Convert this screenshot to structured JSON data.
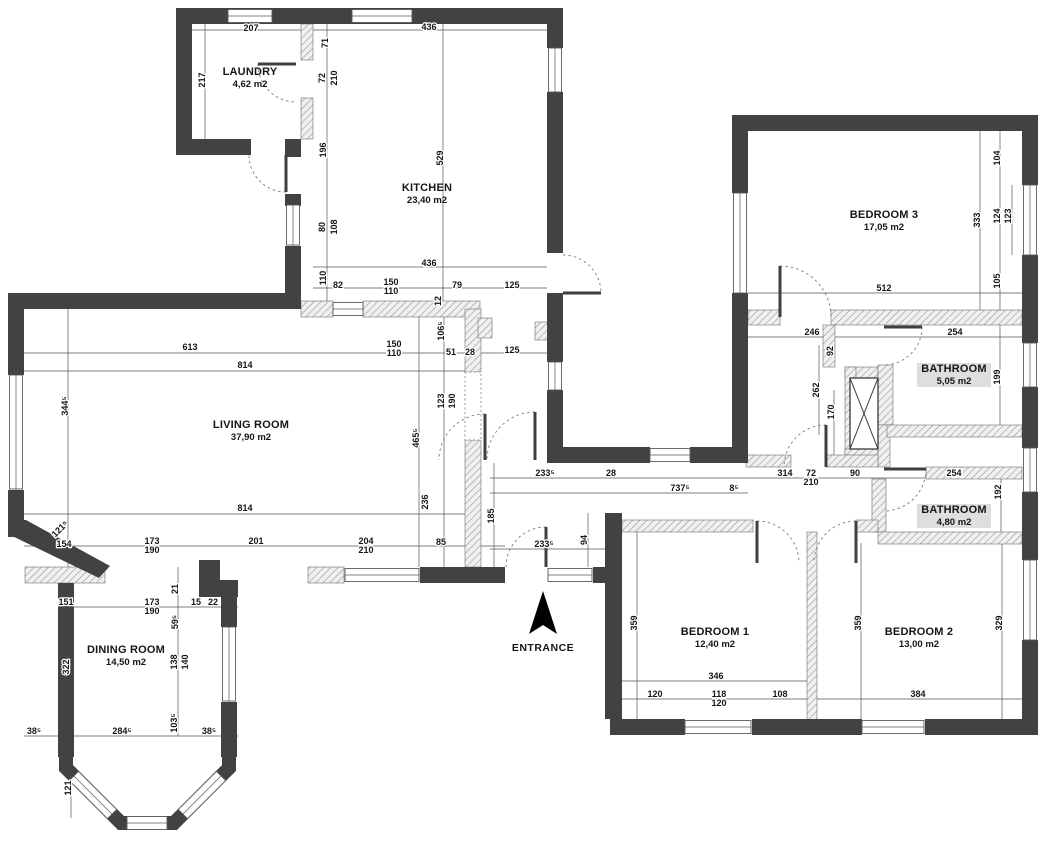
{
  "canvas": {
    "width": 1046,
    "height": 850,
    "background": "#ffffff"
  },
  "colors": {
    "wall": "#424242",
    "hatch_fill": "#f0f0f0",
    "hatch_stroke": "#8f8f8f",
    "dim_line": "#555555",
    "text": "#161616",
    "window_frame": "#5a5a5a",
    "label_highlight": "#dedede",
    "arrow": "#000000",
    "door_arc": "#7a7a7a",
    "door_leaf": "#3f3f3f"
  },
  "entrance": {
    "label": "ENTRANCE",
    "x": 543,
    "y": 651,
    "arrow_points": "543,591 557,634 543,625 529,634"
  },
  "rooms": [
    {
      "id": "laundry",
      "name": "LAUNDRY",
      "area": "4,62 m2",
      "x": 250,
      "y": 75,
      "highlight": false
    },
    {
      "id": "kitchen",
      "name": "KITCHEN",
      "area": "23,40 m2",
      "x": 427,
      "y": 191,
      "highlight": false
    },
    {
      "id": "living-room",
      "name": "LIVING ROOM",
      "area": "37,90 m2",
      "x": 251,
      "y": 428,
      "highlight": false
    },
    {
      "id": "dining-room",
      "name": "DINING ROOM",
      "area": "14,50 m2",
      "x": 126,
      "y": 653,
      "highlight": false
    },
    {
      "id": "bedroom-3",
      "name": "BEDROOM 3",
      "area": "17,05 m2",
      "x": 884,
      "y": 218,
      "highlight": false
    },
    {
      "id": "bathroom-1",
      "name": "BATHROOM",
      "area": "5,05 m2",
      "x": 954,
      "y": 372,
      "highlight": true
    },
    {
      "id": "bathroom-2",
      "name": "BATHROOM",
      "area": "4,80 m2",
      "x": 954,
      "y": 513,
      "highlight": true
    },
    {
      "id": "bedroom-1",
      "name": "BEDROOM 1",
      "area": "12,40 m2",
      "x": 715,
      "y": 635,
      "highlight": false
    },
    {
      "id": "bedroom-2",
      "name": "BEDROOM 2",
      "area": "13,00 m2",
      "x": 919,
      "y": 635,
      "highlight": false
    }
  ],
  "dimensions": [
    {
      "t": "207",
      "x": 251,
      "y": 31,
      "r": 0
    },
    {
      "t": "217",
      "x": 205,
      "y": 80,
      "r": -90
    },
    {
      "t": "436",
      "x": 429,
      "y": 30,
      "r": 0
    },
    {
      "t": "71",
      "x": 328,
      "y": 43,
      "r": -90
    },
    {
      "t": "72",
      "x": 325,
      "y": 78,
      "r": -90
    },
    {
      "t": "210",
      "x": 337,
      "y": 78,
      "r": -90
    },
    {
      "t": "196",
      "x": 326,
      "y": 150,
      "r": -90
    },
    {
      "t": "529",
      "x": 443,
      "y": 158,
      "r": -90
    },
    {
      "t": "80",
      "x": 325,
      "y": 227,
      "r": -90
    },
    {
      "t": "108",
      "x": 337,
      "y": 227,
      "r": -90
    },
    {
      "t": "110",
      "x": 326,
      "y": 278,
      "r": -90
    },
    {
      "t": "436",
      "x": 429,
      "y": 266,
      "r": 0
    },
    {
      "t": "82",
      "x": 338,
      "y": 288,
      "r": 0
    },
    {
      "t": "150",
      "x": 391,
      "y": 285,
      "r": 0
    },
    {
      "t": "110",
      "x": 391,
      "y": 294,
      "r": 0
    },
    {
      "t": "79",
      "x": 457,
      "y": 288,
      "r": 0
    },
    {
      "t": "125",
      "x": 512,
      "y": 288,
      "r": 0
    },
    {
      "t": "12",
      "x": 441,
      "y": 301,
      "r": -90
    },
    {
      "t": "106⁵",
      "x": 444,
      "y": 331,
      "r": -90
    },
    {
      "t": "613",
      "x": 190,
      "y": 350,
      "r": 0
    },
    {
      "t": "150",
      "x": 394,
      "y": 347,
      "r": 0
    },
    {
      "t": "110",
      "x": 394,
      "y": 356,
      "r": 0
    },
    {
      "t": "51",
      "x": 451,
      "y": 355,
      "r": 0
    },
    {
      "t": "28",
      "x": 470,
      "y": 355,
      "r": 0
    },
    {
      "t": "125",
      "x": 512,
      "y": 353,
      "r": 0
    },
    {
      "t": "814",
      "x": 245,
      "y": 368,
      "r": 0
    },
    {
      "t": "344⁵",
      "x": 68,
      "y": 406,
      "r": -90
    },
    {
      "t": "123",
      "x": 444,
      "y": 401,
      "r": -90
    },
    {
      "t": "190",
      "x": 455,
      "y": 401,
      "r": -90
    },
    {
      "t": "465⁵",
      "x": 419,
      "y": 438,
      "r": -90
    },
    {
      "t": "814",
      "x": 245,
      "y": 511,
      "r": 0
    },
    {
      "t": "236",
      "x": 428,
      "y": 502,
      "r": -90
    },
    {
      "t": "185",
      "x": 494,
      "y": 516,
      "r": -90
    },
    {
      "t": "85",
      "x": 441,
      "y": 545,
      "r": 0
    },
    {
      "t": "173",
      "x": 152,
      "y": 544,
      "r": 0
    },
    {
      "t": "190",
      "x": 152,
      "y": 553,
      "r": 0
    },
    {
      "t": "201",
      "x": 256,
      "y": 544,
      "r": 0
    },
    {
      "t": "204",
      "x": 366,
      "y": 544,
      "r": 0
    },
    {
      "t": "210",
      "x": 366,
      "y": 553,
      "r": 0
    },
    {
      "t": "121⁵",
      "x": 62,
      "y": 531,
      "r": -45
    },
    {
      "t": "154",
      "x": 64,
      "y": 547,
      "r": 0
    },
    {
      "t": "151",
      "x": 66,
      "y": 605,
      "r": 0
    },
    {
      "t": "173",
      "x": 152,
      "y": 605,
      "r": 0
    },
    {
      "t": "190",
      "x": 152,
      "y": 614,
      "r": 0
    },
    {
      "t": "15",
      "x": 196,
      "y": 605,
      "r": 0
    },
    {
      "t": "22",
      "x": 213,
      "y": 605,
      "r": 0
    },
    {
      "t": "21",
      "x": 178,
      "y": 589,
      "r": -90
    },
    {
      "t": "59⁵",
      "x": 178,
      "y": 622,
      "r": -90
    },
    {
      "t": "322",
      "x": 69,
      "y": 667,
      "r": -90
    },
    {
      "t": "138",
      "x": 177,
      "y": 662,
      "r": -90
    },
    {
      "t": "140",
      "x": 188,
      "y": 662,
      "r": -90
    },
    {
      "t": "103⁵",
      "x": 177,
      "y": 723,
      "r": -90
    },
    {
      "t": "38⁵",
      "x": 34,
      "y": 734,
      "r": 0
    },
    {
      "t": "284⁵",
      "x": 122,
      "y": 734,
      "r": 0
    },
    {
      "t": "38⁵",
      "x": 209,
      "y": 734,
      "r": 0
    },
    {
      "t": "121",
      "x": 71,
      "y": 788,
      "r": -90
    },
    {
      "t": "233⁵",
      "x": 544,
      "y": 547,
      "r": 0
    },
    {
      "t": "94",
      "x": 587,
      "y": 540,
      "r": -90
    },
    {
      "t": "233⁵",
      "x": 545,
      "y": 476,
      "r": 0
    },
    {
      "t": "28",
      "x": 611,
      "y": 476,
      "r": 0
    },
    {
      "t": "314",
      "x": 785,
      "y": 476,
      "r": 0
    },
    {
      "t": "737⁵",
      "x": 680,
      "y": 491,
      "r": 0
    },
    {
      "t": "8⁵",
      "x": 734,
      "y": 491,
      "r": 0
    },
    {
      "t": "72",
      "x": 811,
      "y": 476,
      "r": 0
    },
    {
      "t": "210",
      "x": 811,
      "y": 485,
      "r": 0
    },
    {
      "t": "90",
      "x": 855,
      "y": 476,
      "r": 0
    },
    {
      "t": "254",
      "x": 954,
      "y": 476,
      "r": 0
    },
    {
      "t": "192",
      "x": 1001,
      "y": 492,
      "r": -90
    },
    {
      "t": "104",
      "x": 1000,
      "y": 158,
      "r": -90
    },
    {
      "t": "333",
      "x": 980,
      "y": 220,
      "r": -90
    },
    {
      "t": "124",
      "x": 1000,
      "y": 216,
      "r": -90
    },
    {
      "t": "123",
      "x": 1011,
      "y": 216,
      "r": -90
    },
    {
      "t": "105",
      "x": 1000,
      "y": 281,
      "r": -90
    },
    {
      "t": "512",
      "x": 884,
      "y": 291,
      "r": 0
    },
    {
      "t": "246",
      "x": 812,
      "y": 335,
      "r": 0
    },
    {
      "t": "254",
      "x": 955,
      "y": 335,
      "r": 0
    },
    {
      "t": "92",
      "x": 833,
      "y": 351,
      "r": -90
    },
    {
      "t": "262",
      "x": 819,
      "y": 390,
      "r": -90
    },
    {
      "t": "170",
      "x": 834,
      "y": 412,
      "r": -90
    },
    {
      "t": "199",
      "x": 1000,
      "y": 377,
      "r": -90
    },
    {
      "t": "359",
      "x": 637,
      "y": 623,
      "r": -90
    },
    {
      "t": "359",
      "x": 861,
      "y": 623,
      "r": -90
    },
    {
      "t": "329",
      "x": 1002,
      "y": 623,
      "r": -90
    },
    {
      "t": "346",
      "x": 716,
      "y": 679,
      "r": 0
    },
    {
      "t": "120",
      "x": 655,
      "y": 697,
      "r": 0
    },
    {
      "t": "118",
      "x": 719,
      "y": 697,
      "r": 0
    },
    {
      "t": "120",
      "x": 719,
      "y": 706,
      "r": 0
    },
    {
      "t": "108",
      "x": 780,
      "y": 697,
      "r": 0
    },
    {
      "t": "384",
      "x": 918,
      "y": 697,
      "r": 0
    }
  ],
  "walls": [
    [
      176,
      8,
      387,
      16
    ],
    [
      176,
      24,
      16,
      131
    ],
    [
      176,
      139,
      75,
      16
    ],
    [
      285,
      139,
      16,
      18
    ],
    [
      285,
      194,
      16,
      12
    ],
    [
      285,
      246,
      16,
      63
    ],
    [
      547,
      24,
      16,
      24
    ],
    [
      547,
      92,
      16,
      161
    ],
    [
      547,
      293,
      16,
      69
    ],
    [
      547,
      390,
      16,
      73
    ],
    [
      547,
      447,
      103,
      16
    ],
    [
      690,
      447,
      58,
      16
    ],
    [
      732,
      115,
      306,
      16
    ],
    [
      732,
      131,
      16,
      62
    ],
    [
      732,
      293,
      16,
      170
    ],
    [
      1022,
      131,
      16,
      54
    ],
    [
      1022,
      255,
      16,
      88
    ],
    [
      1022,
      387,
      16,
      61
    ],
    [
      1022,
      492,
      16,
      68
    ],
    [
      1022,
      640,
      16,
      95
    ],
    [
      610,
      719,
      75,
      16
    ],
    [
      752,
      719,
      110,
      16
    ],
    [
      925,
      719,
      113,
      16
    ],
    [
      605,
      513,
      17,
      206
    ],
    [
      8,
      293,
      293,
      16
    ],
    [
      8,
      309,
      16,
      66
    ],
    [
      8,
      490,
      16,
      47
    ],
    [
      420,
      567,
      85,
      16
    ],
    [
      593,
      567,
      17,
      16
    ],
    [
      199,
      560,
      21,
      20
    ],
    [
      199,
      580,
      39,
      17
    ],
    [
      58,
      583,
      16,
      174
    ],
    [
      221,
      595,
      16,
      32
    ],
    [
      221,
      702,
      16,
      55
    ]
  ],
  "wall_polygons": [
    "8,520 26,520 110,566 99,578 8,534"
  ],
  "bay_outline": "66,757 66,768 121,823 174,823 229,768 229,757",
  "partitions": [
    [
      301,
      24,
      12,
      36
    ],
    [
      301,
      98,
      12,
      41
    ],
    [
      301,
      301,
      32,
      16
    ],
    [
      363,
      301,
      117,
      16
    ],
    [
      465,
      309,
      16,
      63
    ],
    [
      465,
      440,
      16,
      127
    ],
    [
      25,
      567,
      80,
      16
    ],
    [
      308,
      567,
      36,
      16
    ],
    [
      748,
      310,
      32,
      15
    ],
    [
      831,
      310,
      191,
      15
    ],
    [
      823,
      325,
      12,
      42
    ],
    [
      845,
      367,
      33,
      11
    ],
    [
      845,
      367,
      11,
      93
    ],
    [
      845,
      449,
      33,
      11
    ],
    [
      878,
      365,
      15,
      60
    ],
    [
      878,
      425,
      12,
      42
    ],
    [
      887,
      425,
      135,
      12
    ],
    [
      746,
      455,
      45,
      12
    ],
    [
      826,
      455,
      52,
      12
    ],
    [
      926,
      467,
      96,
      12
    ],
    [
      872,
      479,
      14,
      53
    ],
    [
      878,
      532,
      144,
      12
    ],
    [
      622,
      520,
      131,
      12
    ],
    [
      856,
      520,
      22,
      12
    ],
    [
      807,
      532,
      10,
      188
    ],
    [
      478,
      318,
      14,
      20
    ],
    [
      535,
      322,
      15,
      18
    ]
  ],
  "windows": [
    [
      250,
      16,
      44,
      13,
      0
    ],
    [
      382,
      16,
      60,
      13,
      0
    ],
    [
      555,
      70,
      44,
      13,
      90
    ],
    [
      293,
      225,
      40,
      13,
      90
    ],
    [
      16,
      432,
      114,
      13,
      90
    ],
    [
      348,
      309,
      30,
      13,
      0
    ],
    [
      229,
      664,
      74,
      13,
      90
    ],
    [
      670,
      455,
      40,
      13,
      0
    ],
    [
      555,
      376,
      28,
      13,
      90
    ],
    [
      740,
      243,
      100,
      13,
      90
    ],
    [
      1030,
      220,
      70,
      13,
      90
    ],
    [
      1030,
      365,
      44,
      13,
      90
    ],
    [
      1030,
      470,
      44,
      13,
      90
    ],
    [
      1030,
      600,
      80,
      13,
      90
    ],
    [
      718,
      727,
      66,
      13,
      0
    ],
    [
      893,
      727,
      62,
      13,
      0
    ],
    [
      570,
      575,
      44,
      13,
      0
    ],
    [
      382,
      575,
      74,
      13,
      0
    ],
    [
      93,
      795,
      54,
      13,
      45
    ],
    [
      147,
      823,
      40,
      13,
      0
    ],
    [
      202,
      795,
      54,
      13,
      -45
    ]
  ],
  "door_arcs": [
    "M258,64 A38,38 0 0 0 296,102",
    "M286,192 A37,37 0 0 1 249,155",
    "M563,255 A38,38 0 0 1 601,293",
    "M535,412 A48,48 0 0 0 487,460",
    "M546,527 A40,40 0 0 0 506,567",
    "M780,266 A51,51 0 0 1 831,317",
    "M922,327 A38,38 0 0 1 884,365",
    "M826,425 A42,42 0 0 0 784,467",
    "M926,469 A42,42 0 0 1 884,511",
    "M757,521 A42,42 0 0 1 799,563",
    "M856,521 A42,42 0 0 0 814,563",
    "M485,414 A46,46 0 0 0 439,460"
  ],
  "door_leaves": [
    [
      296,
      64,
      258,
      64
    ],
    [
      286,
      155,
      286,
      192
    ],
    [
      563,
      293,
      601,
      293
    ],
    [
      535,
      460,
      535,
      412
    ],
    [
      546,
      567,
      546,
      527
    ],
    [
      780,
      317,
      780,
      266
    ],
    [
      884,
      327,
      922,
      327
    ],
    [
      826,
      467,
      826,
      425
    ],
    [
      884,
      469,
      926,
      469
    ],
    [
      757,
      563,
      757,
      521
    ],
    [
      856,
      563,
      856,
      521
    ],
    [
      485,
      460,
      485,
      414
    ]
  ],
  "dim_lines": [
    [
      192,
      30,
      547,
      30
    ],
    [
      313,
      267,
      547,
      267
    ],
    [
      313,
      288,
      547,
      288
    ],
    [
      24,
      353,
      563,
      353
    ],
    [
      24,
      371,
      465,
      371
    ],
    [
      24,
      514,
      465,
      514
    ],
    [
      24,
      546,
      505,
      546
    ],
    [
      58,
      607,
      238,
      607
    ],
    [
      24,
      736,
      238,
      736
    ],
    [
      490,
      478,
      1022,
      478
    ],
    [
      490,
      493,
      748,
      493
    ],
    [
      490,
      549,
      610,
      549
    ],
    [
      748,
      293,
      1022,
      293
    ],
    [
      748,
      337,
      1022,
      337
    ],
    [
      622,
      681,
      807,
      681
    ],
    [
      622,
      699,
      1022,
      699
    ],
    [
      205,
      24,
      205,
      139
    ],
    [
      327,
      24,
      327,
      301
    ],
    [
      443,
      24,
      443,
      301
    ],
    [
      68,
      309,
      68,
      567
    ],
    [
      444,
      309,
      444,
      567
    ],
    [
      419,
      309,
      419,
      567
    ],
    [
      494,
      463,
      494,
      567
    ],
    [
      588,
      513,
      588,
      567
    ],
    [
      178,
      567,
      178,
      736
    ],
    [
      69,
      583,
      69,
      757
    ],
    [
      71,
      757,
      71,
      818
    ],
    [
      637,
      532,
      637,
      719
    ],
    [
      861,
      543,
      861,
      719
    ],
    [
      1002,
      543,
      1002,
      719
    ],
    [
      980,
      131,
      980,
      310
    ],
    [
      1000,
      131,
      1000,
      310
    ],
    [
      1012,
      185,
      1012,
      255
    ],
    [
      833,
      325,
      833,
      367
    ],
    [
      819,
      345,
      819,
      435
    ],
    [
      834,
      390,
      834,
      455
    ],
    [
      1000,
      325,
      1000,
      425
    ],
    [
      1001,
      467,
      1001,
      533
    ]
  ],
  "dotted_openings": [
    [
      465,
      372,
      16,
      68
    ]
  ],
  "shaft": {
    "x": 850,
    "y": 378,
    "w": 28,
    "h": 71
  }
}
